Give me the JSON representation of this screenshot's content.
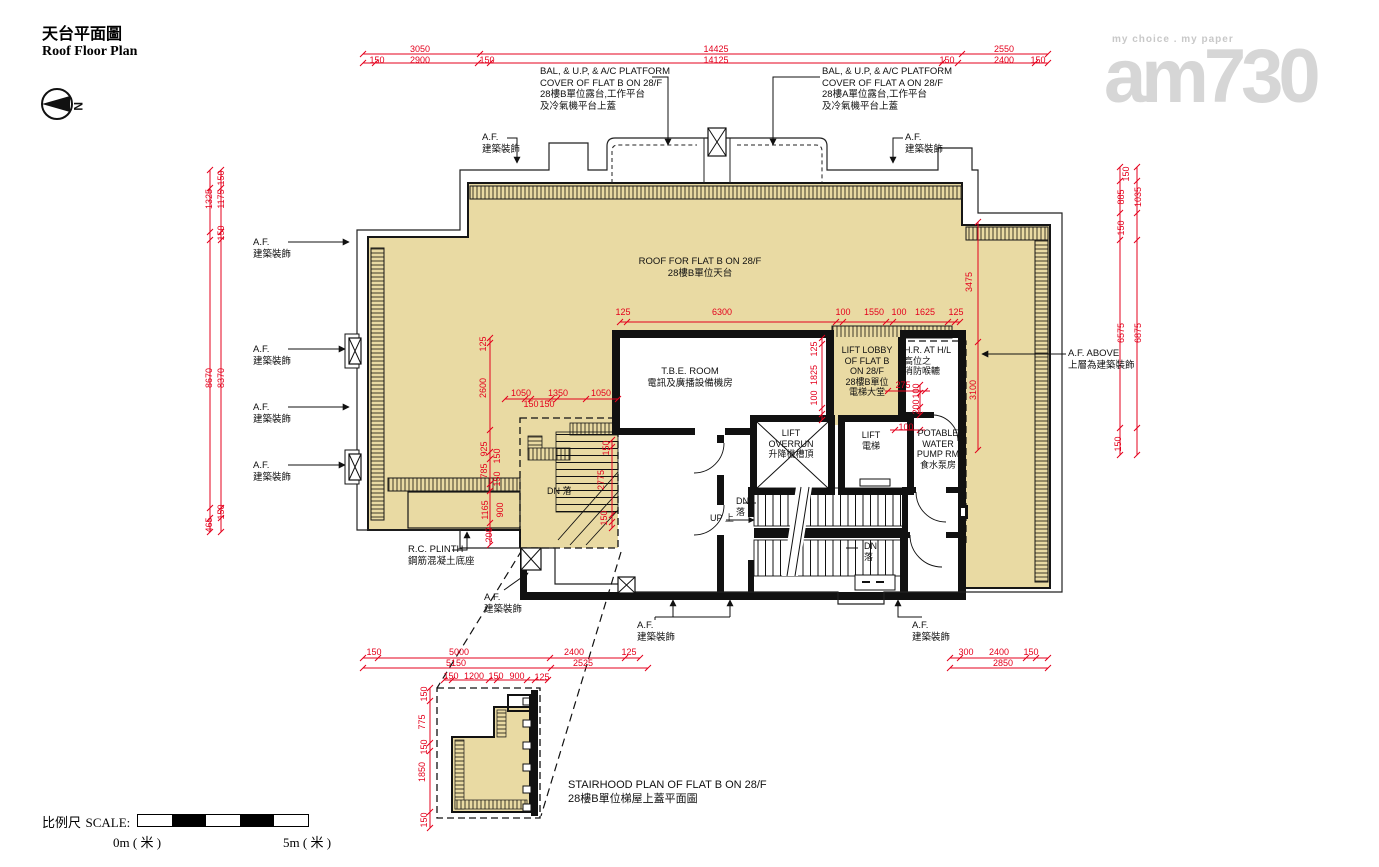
{
  "title": {
    "zh": "天台平面圖",
    "en": "Roof Floor Plan"
  },
  "north": {
    "label": "N"
  },
  "logo": {
    "tagline": "my choice . my paper",
    "text": "am730"
  },
  "scale": {
    "prefix_zh": "比例尺",
    "prefix_en": "SCALE:",
    "zero": "0m ( 米 )",
    "five": "5m ( 米 )"
  },
  "annotations": [
    {
      "lines": [
        "BAL, & U.P, & A/C PLATFORM",
        "COVER OF FLAT B ON 28/F",
        "28樓B單位露台,工作平台",
        "及冷氣機平台上蓋"
      ],
      "x": 540,
      "y": 66,
      "align": "left"
    },
    {
      "lines": [
        "BAL, & U.P, & A/C PLATFORM",
        "COVER OF FLAT A ON 28/F",
        "28樓A單位露台,工作平台",
        "及冷氣機平台上蓋"
      ],
      "x": 822,
      "y": 66,
      "align": "left"
    },
    {
      "lines": [
        "A.F.",
        "建築裝飾"
      ],
      "x": 482,
      "y": 132,
      "align": "left"
    },
    {
      "lines": [
        "A.F.",
        "建築裝飾"
      ],
      "x": 905,
      "y": 132,
      "align": "left"
    },
    {
      "lines": [
        "A.F.",
        "建築裝飾"
      ],
      "x": 253,
      "y": 237,
      "align": "left"
    },
    {
      "lines": [
        "A.F.",
        "建築裝飾"
      ],
      "x": 253,
      "y": 344,
      "align": "left"
    },
    {
      "lines": [
        "A.F.",
        "建築裝飾"
      ],
      "x": 253,
      "y": 402,
      "align": "left"
    },
    {
      "lines": [
        "A.F.",
        "建築裝飾"
      ],
      "x": 253,
      "y": 460,
      "align": "left"
    },
    {
      "lines": [
        "A.F.",
        "建築裝飾"
      ],
      "x": 484,
      "y": 592,
      "align": "left"
    },
    {
      "lines": [
        "A.F.",
        "建築裝飾"
      ],
      "x": 637,
      "y": 620,
      "align": "left"
    },
    {
      "lines": [
        "A.F.",
        "建築裝飾"
      ],
      "x": 912,
      "y": 620,
      "align": "left"
    },
    {
      "lines": [
        "A.F. ABOVE",
        "上層為建築裝飾"
      ],
      "x": 1068,
      "y": 348,
      "align": "left"
    },
    {
      "lines": [
        "ROOF FOR FLAT B ON 28/F",
        "28樓B單位天台"
      ],
      "x": 700,
      "y": 256,
      "align": "center"
    },
    {
      "lines": [
        "T.B.E. ROOM",
        "電訊及廣播設備機房"
      ],
      "x": 690,
      "y": 366,
      "align": "center"
    },
    {
      "lines": [
        "LIFT LOBBY",
        "OF FLAT B",
        "ON 28/F",
        "28樓B單位",
        "電梯大堂"
      ],
      "x": 867,
      "y": 345,
      "align": "center",
      "small": 1
    },
    {
      "lines": [
        "H.R. AT H/L",
        "高位之",
        "消防喉轆"
      ],
      "x": 904,
      "y": 345,
      "align": "left",
      "small": 1
    },
    {
      "lines": [
        "LIFT",
        "OVERRUN",
        "升降機槽頂"
      ],
      "x": 791,
      "y": 428,
      "align": "center",
      "small": 1
    },
    {
      "lines": [
        "LIFT",
        "電梯"
      ],
      "x": 871,
      "y": 430,
      "align": "center",
      "small": 1
    },
    {
      "lines": [
        "POTABLE",
        "WATER",
        "PUMP RM",
        "食水泵房"
      ],
      "x": 938,
      "y": 428,
      "align": "center",
      "small": 1
    },
    {
      "lines": [
        "R.C. PLINTH",
        "鋼筋混凝土底座"
      ],
      "x": 408,
      "y": 544,
      "align": "left"
    },
    {
      "lines": [
        "STAIRHOOD PLAN OF FLAT B ON 28/F",
        "28樓B單位梯屋上蓋平面圖"
      ],
      "x": 568,
      "y": 778,
      "align": "left",
      "big": 1
    },
    {
      "lines": [
        "DN 落"
      ],
      "x": 547,
      "y": 486,
      "align": "left",
      "small": 1
    },
    {
      "lines": [
        "DN",
        "落"
      ],
      "x": 736,
      "y": 496,
      "align": "left",
      "small": 1
    },
    {
      "lines": [
        "UP 上"
      ],
      "x": 710,
      "y": 513,
      "align": "left",
      "small": 1
    },
    {
      "lines": [
        "DN",
        "落"
      ],
      "x": 864,
      "y": 541,
      "align": "left",
      "small": 1
    }
  ],
  "dims": [
    {
      "t": "3050",
      "x": 420,
      "y": 49
    },
    {
      "t": "150",
      "x": 377,
      "y": 60
    },
    {
      "t": "2900",
      "x": 420,
      "y": 60
    },
    {
      "t": "150",
      "x": 487,
      "y": 60
    },
    {
      "t": "14425",
      "x": 716,
      "y": 49
    },
    {
      "t": "14125",
      "x": 716,
      "y": 60
    },
    {
      "t": "2550",
      "x": 1004,
      "y": 49
    },
    {
      "t": "150",
      "x": 947,
      "y": 60
    },
    {
      "t": "2400",
      "x": 1004,
      "y": 60
    },
    {
      "t": "150",
      "x": 1038,
      "y": 60
    },
    {
      "t": "150",
      "x": 221,
      "y": 178,
      "r": 1
    },
    {
      "t": "1325",
      "x": 209,
      "y": 199,
      "r": 1
    },
    {
      "t": "1175",
      "x": 221,
      "y": 199,
      "r": 1
    },
    {
      "t": "150",
      "x": 221,
      "y": 233,
      "r": 1
    },
    {
      "t": "8670",
      "x": 209,
      "y": 378,
      "r": 1
    },
    {
      "t": "8370",
      "x": 221,
      "y": 378,
      "r": 1
    },
    {
      "t": "150",
      "x": 221,
      "y": 512,
      "r": 1
    },
    {
      "t": "465",
      "x": 209,
      "y": 525,
      "r": 1
    },
    {
      "t": "150",
      "x": 1126,
      "y": 174,
      "r": 1
    },
    {
      "t": "885",
      "x": 1121,
      "y": 197,
      "r": 1
    },
    {
      "t": "1035",
      "x": 1138,
      "y": 197,
      "r": 1
    },
    {
      "t": "150",
      "x": 1121,
      "y": 228,
      "r": 1
    },
    {
      "t": "6575",
      "x": 1121,
      "y": 333,
      "r": 1
    },
    {
      "t": "6875",
      "x": 1138,
      "y": 333,
      "r": 1
    },
    {
      "t": "150",
      "x": 1118,
      "y": 444,
      "r": 1
    },
    {
      "t": "125",
      "x": 623,
      "y": 312
    },
    {
      "t": "6300",
      "x": 722,
      "y": 312
    },
    {
      "t": "100",
      "x": 843,
      "y": 312
    },
    {
      "t": "1550",
      "x": 874,
      "y": 312
    },
    {
      "t": "100",
      "x": 899,
      "y": 312
    },
    {
      "t": "1625",
      "x": 925,
      "y": 312
    },
    {
      "t": "125",
      "x": 956,
      "y": 312
    },
    {
      "t": "125",
      "x": 814,
      "y": 349,
      "r": 1
    },
    {
      "t": "1825",
      "x": 814,
      "y": 375,
      "r": 1
    },
    {
      "t": "100",
      "x": 814,
      "y": 398,
      "r": 1
    },
    {
      "t": "3475",
      "x": 969,
      "y": 282,
      "r": 1
    },
    {
      "t": "3100",
      "x": 973,
      "y": 390,
      "r": 1
    },
    {
      "t": "1050",
      "x": 521,
      "y": 393
    },
    {
      "t": "1350",
      "x": 558,
      "y": 393
    },
    {
      "t": "1050",
      "x": 601,
      "y": 393
    },
    {
      "t": "150",
      "x": 531,
      "y": 404
    },
    {
      "t": "150",
      "x": 547,
      "y": 404
    },
    {
      "t": "125",
      "x": 483,
      "y": 344,
      "r": 1
    },
    {
      "t": "2600",
      "x": 483,
      "y": 388,
      "r": 1
    },
    {
      "t": "925",
      "x": 484,
      "y": 449,
      "r": 1
    },
    {
      "t": "150",
      "x": 497,
      "y": 456,
      "r": 1
    },
    {
      "t": "785",
      "x": 484,
      "y": 471,
      "r": 1
    },
    {
      "t": "150",
      "x": 497,
      "y": 479,
      "r": 1
    },
    {
      "t": "1165",
      "x": 485,
      "y": 510,
      "r": 1
    },
    {
      "t": "900",
      "x": 500,
      "y": 510,
      "r": 1
    },
    {
      "t": "200",
      "x": 489,
      "y": 535,
      "r": 1
    },
    {
      "t": "150",
      "x": 606,
      "y": 448,
      "r": 1
    },
    {
      "t": "2775",
      "x": 601,
      "y": 480,
      "r": 1
    },
    {
      "t": "150",
      "x": 604,
      "y": 518,
      "r": 1
    },
    {
      "t": "275",
      "x": 903,
      "y": 385
    },
    {
      "t": "100",
      "x": 916,
      "y": 391,
      "r": 1
    },
    {
      "t": "200",
      "x": 916,
      "y": 407,
      "r": 1
    },
    {
      "t": "100",
      "x": 906,
      "y": 427
    },
    {
      "t": "150",
      "x": 374,
      "y": 652
    },
    {
      "t": "5000",
      "x": 459,
      "y": 652
    },
    {
      "t": "2400",
      "x": 574,
      "y": 652
    },
    {
      "t": "125",
      "x": 629,
      "y": 652
    },
    {
      "t": "5150",
      "x": 456,
      "y": 663
    },
    {
      "t": "2525",
      "x": 583,
      "y": 663
    },
    {
      "t": "150",
      "x": 451,
      "y": 676
    },
    {
      "t": "1200",
      "x": 474,
      "y": 676
    },
    {
      "t": "150",
      "x": 496,
      "y": 676
    },
    {
      "t": "900",
      "x": 517,
      "y": 676
    },
    {
      "t": "125",
      "x": 542,
      "y": 677
    },
    {
      "t": "300",
      "x": 966,
      "y": 652
    },
    {
      "t": "2400",
      "x": 999,
      "y": 652
    },
    {
      "t": "150",
      "x": 1031,
      "y": 652
    },
    {
      "t": "2850",
      "x": 1003,
      "y": 663
    },
    {
      "t": "150",
      "x": 424,
      "y": 694,
      "r": 1
    },
    {
      "t": "775",
      "x": 422,
      "y": 722,
      "r": 1
    },
    {
      "t": "150",
      "x": 424,
      "y": 747,
      "r": 1
    },
    {
      "t": "1850",
      "x": 422,
      "y": 772,
      "r": 1
    },
    {
      "t": "150",
      "x": 424,
      "y": 820,
      "r": 1
    }
  ]
}
